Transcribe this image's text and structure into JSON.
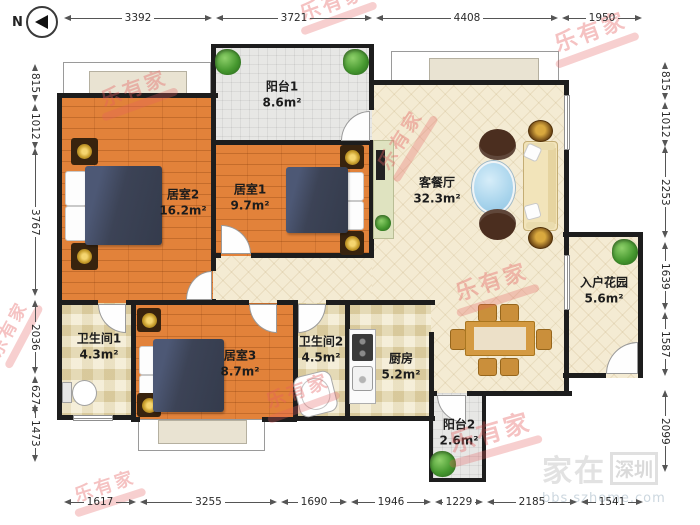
{
  "compass": {
    "label": "N"
  },
  "dimensions": {
    "top": [
      "3392",
      "3721",
      "4408",
      "1950"
    ],
    "bottom": [
      "1617",
      "3255",
      "1690",
      "1946",
      "1229",
      "2185",
      "1541"
    ],
    "left": [
      "815",
      "1012",
      "3767",
      "2036",
      "627",
      "1473"
    ],
    "right": [
      "815",
      "1012",
      "2253",
      "1639",
      "1587",
      "2099"
    ]
  },
  "rooms": [
    {
      "name": "阳台1",
      "area": "8.6m²"
    },
    {
      "name": "居室2",
      "area": "16.2m²"
    },
    {
      "name": "居室1",
      "area": "9.7m²"
    },
    {
      "name": "客餐厅",
      "area": "32.3m²"
    },
    {
      "name": "入户花园",
      "area": "5.6m²"
    },
    {
      "name": "卫生间1",
      "area": "4.3m²"
    },
    {
      "name": "居室3",
      "area": "8.7m²"
    },
    {
      "name": "卫生间2",
      "area": "4.5m²"
    },
    {
      "name": "厨房",
      "area": "5.2m²"
    },
    {
      "name": "阳台2",
      "area": "2.6m²"
    }
  ],
  "watermarks": {
    "brand": "乐有家",
    "site_part1": "家在",
    "site_part2": "深圳",
    "site_url": "bbs.szhome.com"
  },
  "colors": {
    "wall": "#1d1d1d",
    "wood_floor": "#e2823a",
    "beige_floor": "#f4ebd3",
    "balcony_floor": "#e7e7e5",
    "brand_watermark": "#e65f5f",
    "bed": "#3c4356",
    "table_glass": "#a8d4ec"
  }
}
